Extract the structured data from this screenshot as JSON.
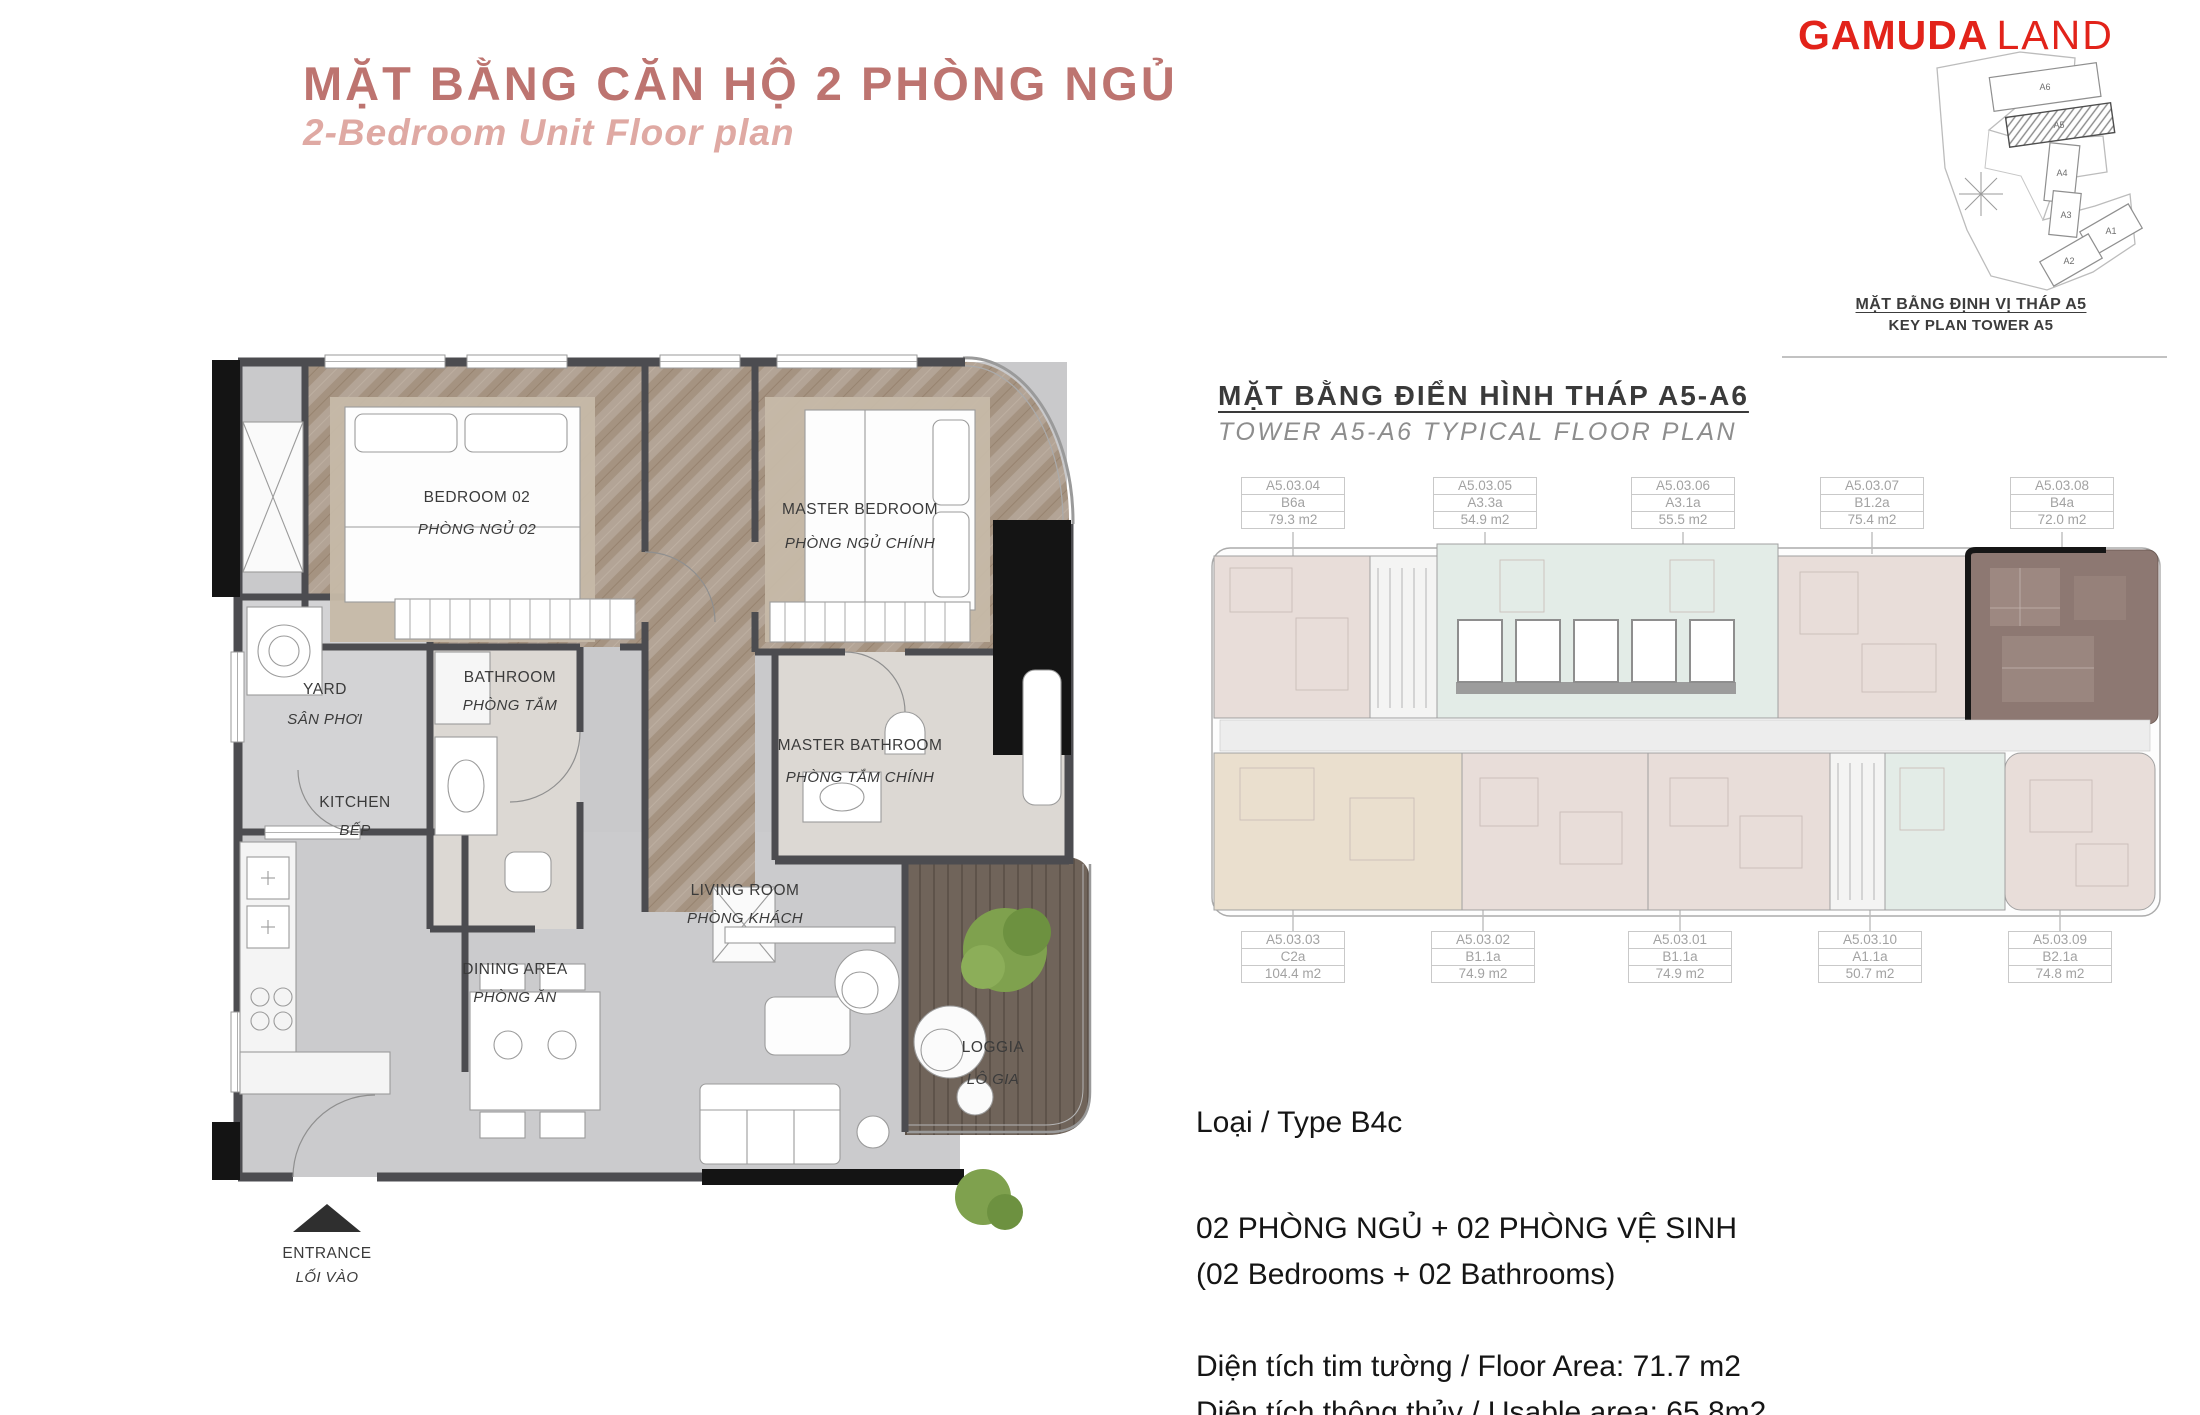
{
  "header": {
    "title": "MẶT BẰNG CĂN HỘ 2 PHÒNG NGỦ",
    "subtitle": "2-Bedroom Unit Floor plan"
  },
  "logo": {
    "bold": "GAMUDA",
    "light": "LAND"
  },
  "key_plan": {
    "caption_vi": "MẶT BẰNG ĐỊNH VỊ THÁP A5",
    "caption_en": "KEY PLAN TOWER A5",
    "towers": {
      "a6": "A6",
      "a5": "A5",
      "a4": "A4",
      "a3": "A3",
      "a1": "A1",
      "a2": "A2"
    }
  },
  "typical_plan": {
    "title_vi": "MẶT BẰNG ĐIỂN HÌNH THÁP A5-A6",
    "title_en": "TOWER A5-A6 TYPICAL FLOOR PLAN",
    "units_top": [
      {
        "code": "A5.03.04",
        "type": "B6a",
        "area": "79.3 m2"
      },
      {
        "code": "A5.03.05",
        "type": "A3.3a",
        "area": "54.9 m2"
      },
      {
        "code": "A5.03.06",
        "type": "A3.1a",
        "area": "55.5 m2"
      },
      {
        "code": "A5.03.07",
        "type": "B1.2a",
        "area": "75.4 m2"
      },
      {
        "code": "A5.03.08",
        "type": "B4a",
        "area": "72.0 m2"
      }
    ],
    "units_bottom": [
      {
        "code": "A5.03.03",
        "type": "C2a",
        "area": "104.4 m2"
      },
      {
        "code": "A5.03.02",
        "type": "B1.1a",
        "area": "74.9 m2"
      },
      {
        "code": "A5.03.01",
        "type": "B1.1a",
        "area": "74.9 m2"
      },
      {
        "code": "A5.03.10",
        "type": "A1.1a",
        "area": "50.7 m2"
      },
      {
        "code": "A5.03.09",
        "type": "B2.1a",
        "area": "74.8 m2"
      }
    ]
  },
  "floor_plan": {
    "rooms": {
      "bedroom02": {
        "en": "BEDROOM 02",
        "vi": "PHÒNG NGỦ 02"
      },
      "master_bedroom": {
        "en": "MASTER BEDROOM",
        "vi": "PHÒNG NGỦ CHÍNH"
      },
      "yard": {
        "en": "YARD",
        "vi": "SÂN PHƠI"
      },
      "bathroom": {
        "en": "BATHROOM",
        "vi": "PHÒNG TẮM"
      },
      "kitchen": {
        "en": "KITCHEN",
        "vi": "BẾP"
      },
      "master_bathroom": {
        "en": "MASTER BATHROOM",
        "vi": "PHÒNG TẮM CHÍNH"
      },
      "dining": {
        "en": "DINING AREA",
        "vi": "PHÒNG ĂN"
      },
      "living": {
        "en": "LIVING ROOM",
        "vi": "PHÒNG KHÁCH"
      },
      "loggia": {
        "en": "LOGGIA",
        "vi": "LÔ GIA"
      }
    },
    "entrance": {
      "en": "ENTRANCE",
      "vi": "LỐI VÀO"
    }
  },
  "unit_info": {
    "type": "Loại / Type B4c",
    "config_vi": "02 PHÒNG NGỦ + 02 PHÒNG VỆ SINH",
    "config_en": "(02 Bedrooms + 02 Bathrooms)",
    "floor_area": "Diện tích tim tường / Floor Area: 71.7 m2",
    "usable_area": "Diện tích thông thủy / Usable area: 65.8m2"
  },
  "colors": {
    "accent_title": "#bd7470",
    "accent_subtitle": "#dfa9a3",
    "brand_red": "#e2231a",
    "highlight_unit": "#8d7872",
    "unit_pink": "#e8ddd9",
    "unit_tan": "#eadfce",
    "unit_mint": "#e3ece7"
  }
}
